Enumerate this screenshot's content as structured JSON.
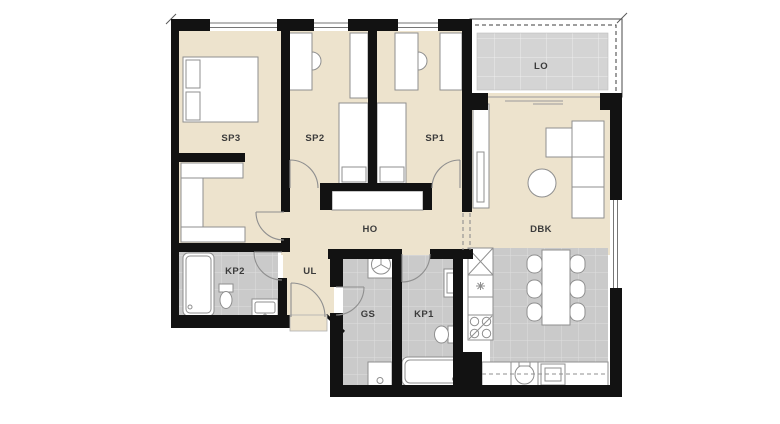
{
  "plan": {
    "type": "apartment-floor-plan",
    "labels": {
      "sp3": "SP3",
      "sp2": "SP2",
      "sp1": "SP1",
      "lo": "LO",
      "ho": "HO",
      "dbk": "DBK",
      "kp2": "KP2",
      "ul": "UL",
      "gs": "GS",
      "kp1": "KP1"
    }
  },
  "colors": {
    "bg": "#FFFFFF",
    "floor": "#EDE3CD",
    "tile": "#CACACA",
    "grout": "#DEDEDE",
    "lotile": "#D4D4D4",
    "logrout": "#EDEDED",
    "wall": "#121212",
    "line": "#8F8F8F",
    "door": "#8F8F8F",
    "label": "#3B3B3B"
  }
}
